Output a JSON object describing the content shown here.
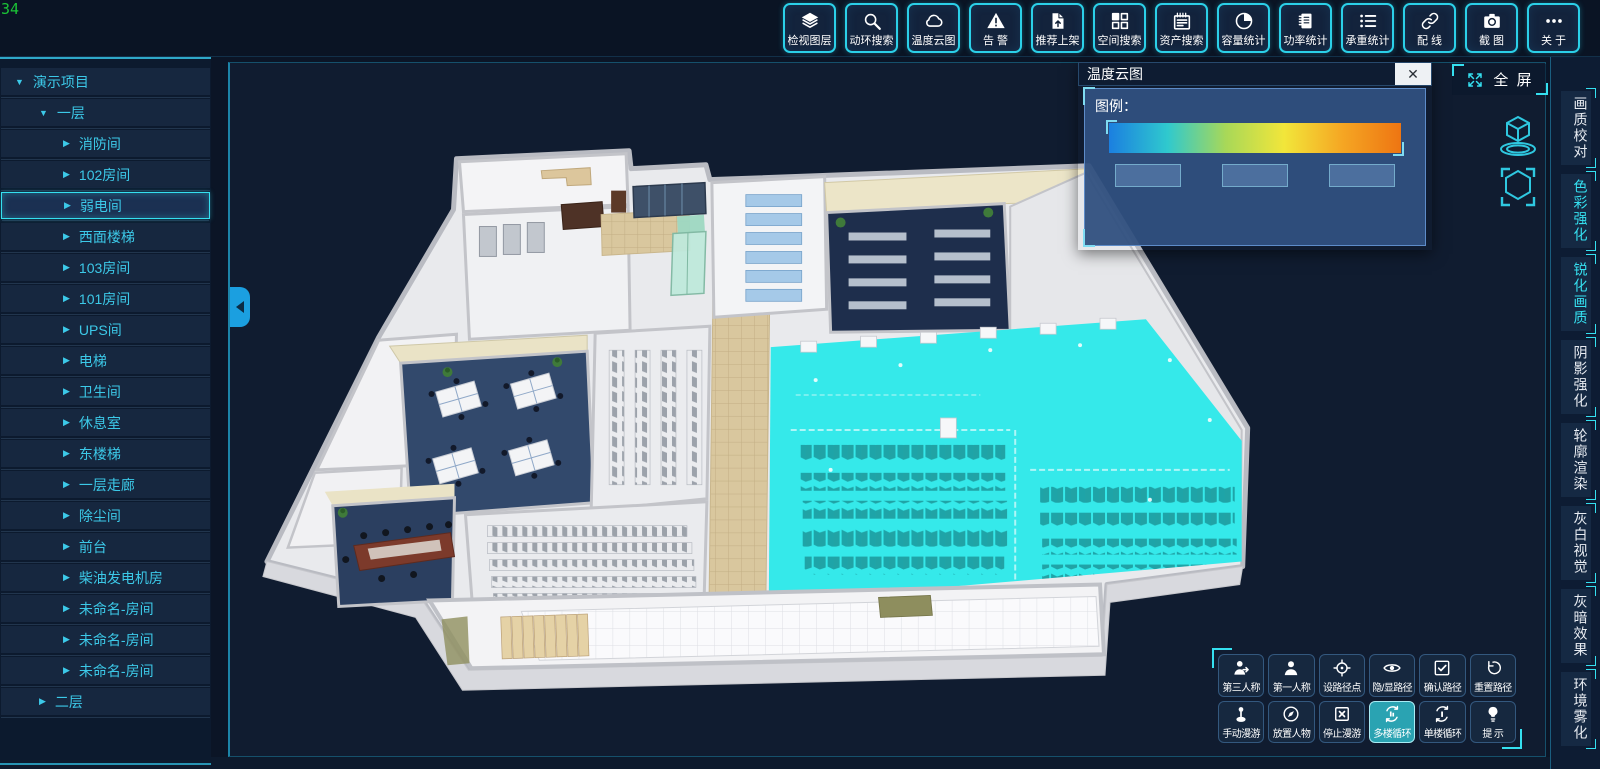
{
  "meta": {
    "fps": "34"
  },
  "top_toolbar": {
    "items": [
      {
        "label": "检视图层",
        "icon": "layers-icon"
      },
      {
        "label": "动环搜索",
        "icon": "search-icon"
      },
      {
        "label": "温度云图",
        "icon": "cloud-icon"
      },
      {
        "label": "告 警",
        "icon": "alert-icon"
      },
      {
        "label": "推荐上架",
        "icon": "recommend-icon"
      },
      {
        "label": "空间搜索",
        "icon": "space-search-icon"
      },
      {
        "label": "资产搜索",
        "icon": "asset-search-icon"
      },
      {
        "label": "容量统计",
        "icon": "capacity-icon"
      },
      {
        "label": "功率统计",
        "icon": "power-icon"
      },
      {
        "label": "承重统计",
        "icon": "weight-icon"
      },
      {
        "label": "配 线",
        "icon": "wiring-icon"
      },
      {
        "label": "截 图",
        "icon": "camera-icon"
      },
      {
        "label": "关 于",
        "icon": "about-icon"
      }
    ]
  },
  "project_tree": {
    "items": [
      {
        "label": "演示项目",
        "level": 0,
        "arrow": "▼"
      },
      {
        "label": "一层",
        "level": 1,
        "arrow": "▼"
      },
      {
        "label": "消防间",
        "level": 2,
        "arrow": "▶"
      },
      {
        "label": "102房间",
        "level": 2,
        "arrow": "▶"
      },
      {
        "label": "弱电间",
        "level": 2,
        "arrow": "▶",
        "state": "selected"
      },
      {
        "label": "西面楼梯",
        "level": 2,
        "arrow": "▶"
      },
      {
        "label": "103房间",
        "level": 2,
        "arrow": "▶"
      },
      {
        "label": "101房间",
        "level": 2,
        "arrow": "▶"
      },
      {
        "label": "UPS间",
        "level": 2,
        "arrow": "▶"
      },
      {
        "label": "电梯",
        "level": 2,
        "arrow": "▶"
      },
      {
        "label": "卫生间",
        "level": 2,
        "arrow": "▶"
      },
      {
        "label": "休息室",
        "level": 2,
        "arrow": "▶"
      },
      {
        "label": "东楼梯",
        "level": 2,
        "arrow": "▶"
      },
      {
        "label": "一层走廊",
        "level": 2,
        "arrow": "▶"
      },
      {
        "label": "除尘间",
        "level": 2,
        "arrow": "▶"
      },
      {
        "label": "前台",
        "level": 2,
        "arrow": "▶"
      },
      {
        "label": "柴油发电机房",
        "level": 2,
        "arrow": "▶"
      },
      {
        "label": "未命名-房间",
        "level": 2,
        "arrow": "▶"
      },
      {
        "label": "未命名-房间",
        "level": 2,
        "arrow": "▶"
      },
      {
        "label": "未命名-房间",
        "level": 2,
        "arrow": "▶"
      },
      {
        "label": "二层",
        "level": 1,
        "arrow": "▶"
      }
    ]
  },
  "viewport": {
    "fullscreen_label": "全 屏"
  },
  "temp_panel": {
    "title": "温度云图",
    "close_label": "✕",
    "legend_label": "图例：",
    "scale_labels": [
      {
        "text": "正常",
        "color": "#F2F7FC"
      },
      {
        "text": "正常",
        "color": "#F2F7FC"
      },
      {
        "text": "注意",
        "color": "#F2D23C"
      },
      {
        "text": "告警",
        "color": "#F08A2C"
      }
    ],
    "gradient_colors": [
      "#1B7FE0",
      "#2FC9CE",
      "#A8D858",
      "#F2E63A",
      "#F5A623",
      "#EE7512"
    ],
    "temperatures": [
      "15°C",
      "20°C",
      "25°C"
    ],
    "layer_buttons": [
      "上层",
      "中层",
      "下层"
    ]
  },
  "display_sidebar": {
    "items": [
      {
        "label": "画质校对"
      },
      {
        "label": "色彩强化",
        "state": "cyan"
      },
      {
        "label": "锐化画质",
        "state": "cyan"
      },
      {
        "label": "阴影强化"
      },
      {
        "label": "轮廓渲染"
      },
      {
        "label": "灰白视觉"
      },
      {
        "label": "灰暗效果"
      },
      {
        "label": "环境雾化"
      }
    ]
  },
  "roam_toolbar": {
    "items": [
      {
        "label": "第三人称",
        "icon": "third-person-icon"
      },
      {
        "label": "第一人称",
        "icon": "first-person-icon"
      },
      {
        "label": "设路径点",
        "icon": "waypoint-icon"
      },
      {
        "label": "隐/显路径",
        "icon": "eye-icon"
      },
      {
        "label": "确认路径",
        "icon": "confirm-icon"
      },
      {
        "label": "重置路径",
        "icon": "reset-icon"
      },
      {
        "label": "手动漫游",
        "icon": "joystick-icon"
      },
      {
        "label": "放置人物",
        "icon": "compass-icon"
      },
      {
        "label": "停止漫游",
        "icon": "stop-icon"
      },
      {
        "label": "多楼循环",
        "icon": "multi-floor-loop-icon",
        "state": "active"
      },
      {
        "label": "单楼循环",
        "icon": "single-floor-loop-icon"
      },
      {
        "label": "提 示",
        "icon": "bulb-icon"
      }
    ]
  },
  "colors": {
    "accent": "#35E0F0",
    "temperature_cloud": "#35E9EA",
    "caution": "#F2D23C",
    "alert": "#F08A2C",
    "selected_tree_item": "#35E0F0"
  }
}
